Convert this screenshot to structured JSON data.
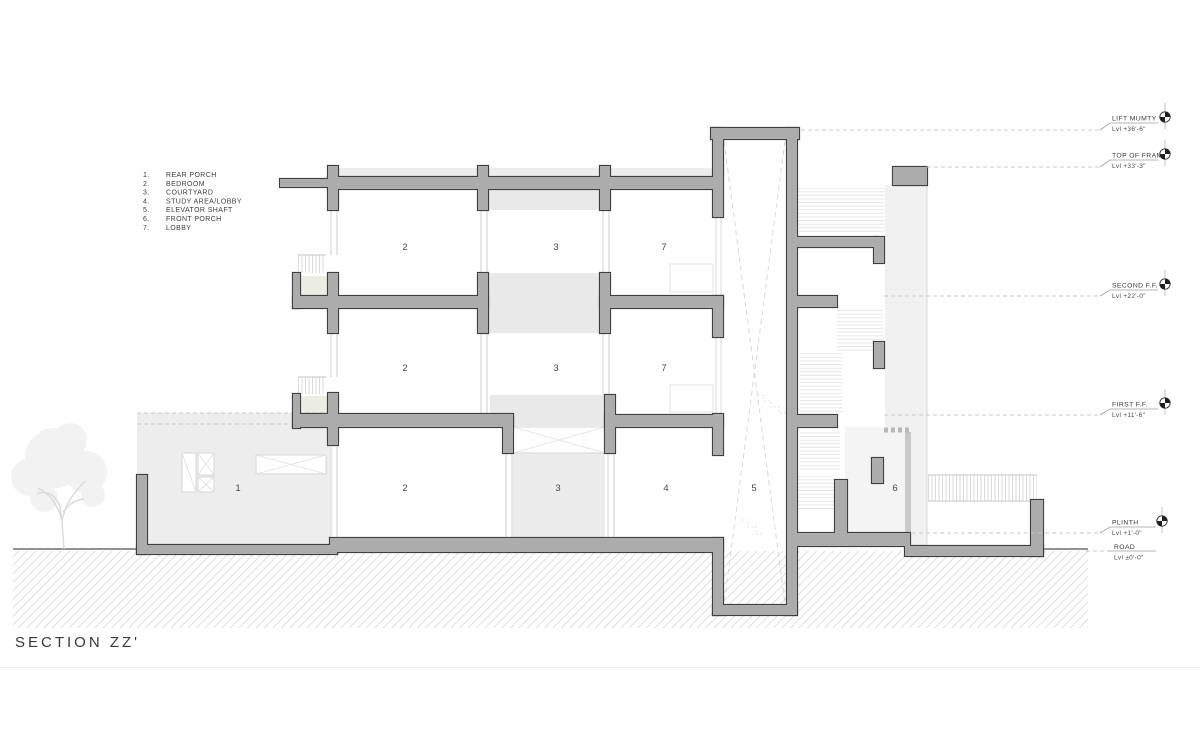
{
  "title": "SECTION ZZ'",
  "legend": {
    "items": [
      {
        "num": "1.",
        "label": "REAR PORCH"
      },
      {
        "num": "2.",
        "label": "BEDROOM"
      },
      {
        "num": "3.",
        "label": "COURTYARD"
      },
      {
        "num": "4.",
        "label": "STUDY AREA/LOBBY"
      },
      {
        "num": "5.",
        "label": "ELEVATOR SHAFT"
      },
      {
        "num": "6.",
        "label": "FRONT PORCH"
      },
      {
        "num": "7.",
        "label": "LOBBY"
      }
    ]
  },
  "levels": [
    {
      "name": "LIFT MUMTY",
      "level": "Lvl +36'-6\""
    },
    {
      "name": "TOP OF FRAME",
      "level": "Lvl +33'-3\""
    },
    {
      "name": "SECOND F.F.",
      "level": "Lvl +22'-0\""
    },
    {
      "name": "FIRST F.F.",
      "level": "Lvl +11'-6\""
    },
    {
      "name": "PLINTH",
      "level": "Lvl +1'-0\""
    },
    {
      "name": "ROAD",
      "level": "Lvl ±0'-0\""
    }
  ],
  "rooms": {
    "second": [
      "2",
      "3",
      "7"
    ],
    "first": [
      "2",
      "3",
      "7"
    ],
    "ground": [
      "1",
      "2",
      "3",
      "4",
      "5",
      "6"
    ]
  },
  "colors": {
    "wall_fill": "#acacac",
    "wall_outline": "#3f3f3f",
    "beyond_fill": "#ececec",
    "hatch_line": "#dedede"
  }
}
